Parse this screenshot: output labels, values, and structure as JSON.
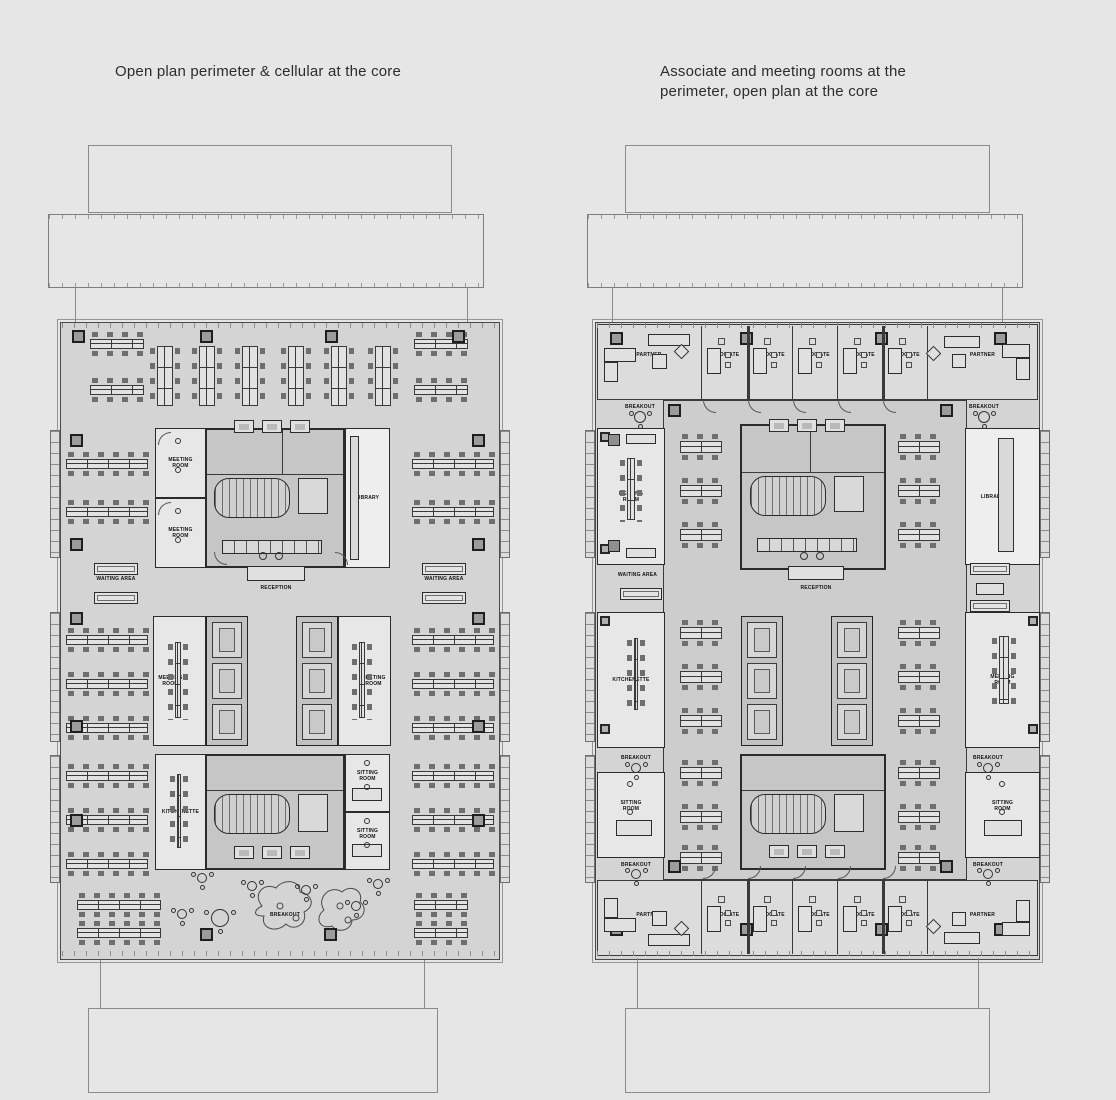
{
  "titles": {
    "left": "Open plan perimeter & cellular at the core",
    "right": "Associate and meeting rooms at the\nperimeter, open plan at the core"
  },
  "left_plan": {
    "rooms": {
      "meeting_room_top_a": "MEETING ROOM",
      "meeting_room_top_b": "MEETING ROOM",
      "library": "LIBRARY",
      "reception": "RECEPTION",
      "waiting_area_left": "WAITING AREA",
      "waiting_area_right": "WAITING AREA",
      "meeting_room_mid_left": "MEETING ROOM",
      "meeting_room_mid_right": "MEETING ROOM",
      "kitchenette": "KITCHENETTE",
      "sitting_room_a": "SITTING ROOM",
      "sitting_room_b": "SITTING ROOM",
      "breakout": "BREAKOUT"
    }
  },
  "right_plan": {
    "top_offices": [
      "PARTNER",
      "ASSOCIATE",
      "ASSOCIATE",
      "ASSOCIATE",
      "ASSOCIATE",
      "ASSOCIATE",
      "PARTNER"
    ],
    "bottom_offices": [
      "PARTNER",
      "ASSOCIATE",
      "ASSOCIATE",
      "ASSOCIATE",
      "ASSOCIATE",
      "ASSOCIATE",
      "PARTNER"
    ],
    "rooms": {
      "meeting_room_left": "MEETING ROOM",
      "kitchenette": "KITCHENETTE",
      "sitting_room_left": "SITTING ROOM",
      "waiting_area": "WAITING AREA",
      "reception": "RECEPTION",
      "library": "LIBRARY",
      "meeting_room_right": "MEETING ROOM",
      "sitting_room_right": "SITTING ROOM",
      "breakout_top_left": "BREAKOUT",
      "breakout_top_right": "BREAKOUT",
      "breakout_mid_left": "BREAKOUT",
      "breakout_mid_right": "BREAKOUT",
      "breakout_bottom_left": "BREAKOUT",
      "breakout_bottom_right": "BREAKOUT"
    }
  },
  "colors": {
    "background": "#e6e6e6",
    "floor": "#d4d4d4",
    "core": "#c6c6c6",
    "office_band": "#dcdcdc",
    "open_plan_core": "#cdcdcd",
    "wall": "#3a3a3a"
  }
}
